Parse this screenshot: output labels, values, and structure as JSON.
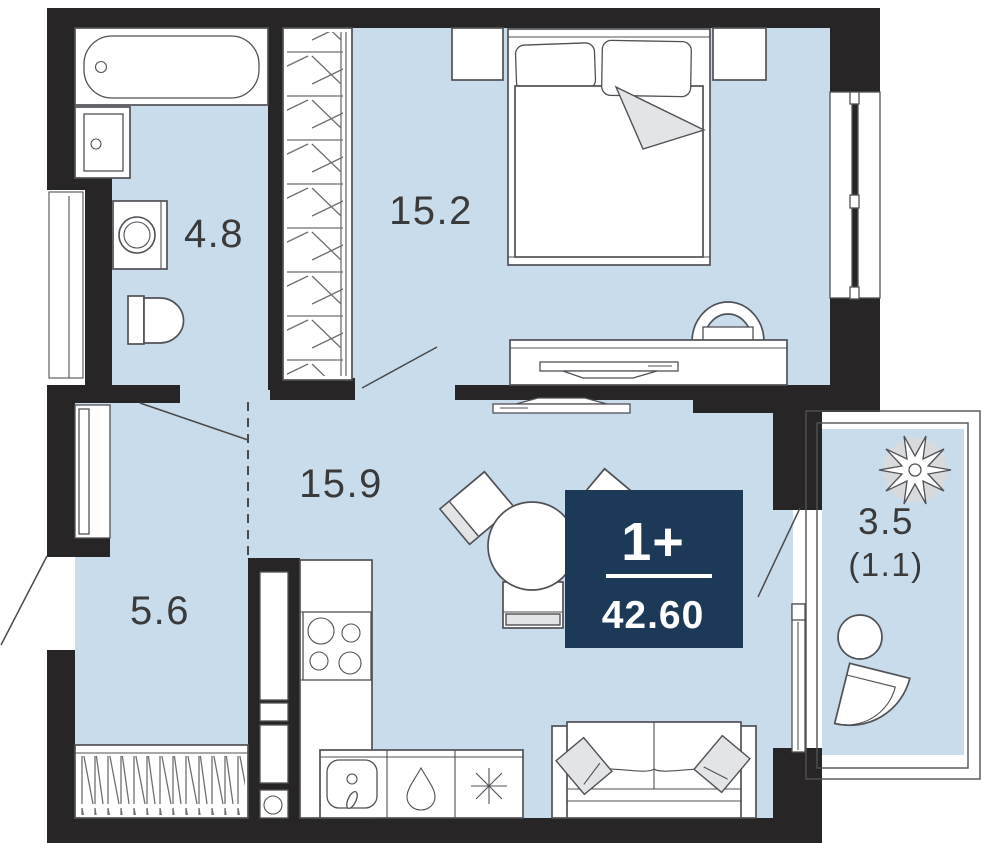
{
  "plan": {
    "badge": {
      "rooms": "1+",
      "area": "42.60"
    },
    "rooms": [
      {
        "id": "bathroom",
        "area": "4.8"
      },
      {
        "id": "bedroom",
        "area": "15.2"
      },
      {
        "id": "kitchen-living-room",
        "area": "15.9"
      },
      {
        "id": "hallway",
        "area": "5.6"
      },
      {
        "id": "balcony",
        "area": "3.5",
        "area_reduced": "(1.1)"
      }
    ],
    "furniture": [
      "bathtub",
      "bathroom-sink",
      "washing-machine",
      "toilet",
      "wardrobe",
      "double-bed",
      "nightstand",
      "desk",
      "desk-chair",
      "tv",
      "dining-table",
      "dining-chair",
      "kitchen-counter",
      "stove",
      "kitchen-sink",
      "dishwasher-icon",
      "fridge-icon",
      "sofa",
      "hallway-wardrobe",
      "balcony-table",
      "balcony-chair",
      "plant"
    ],
    "colors": {
      "wall": "#272525",
      "room_fill": "#c9dcec",
      "line": "#505156",
      "line_soft": "#6e6f71",
      "accent_fill": "#e3e4e5",
      "label": "#3a3a3a",
      "badge_bg": "#1c3a57",
      "badge_text": "#ffffff"
    }
  }
}
